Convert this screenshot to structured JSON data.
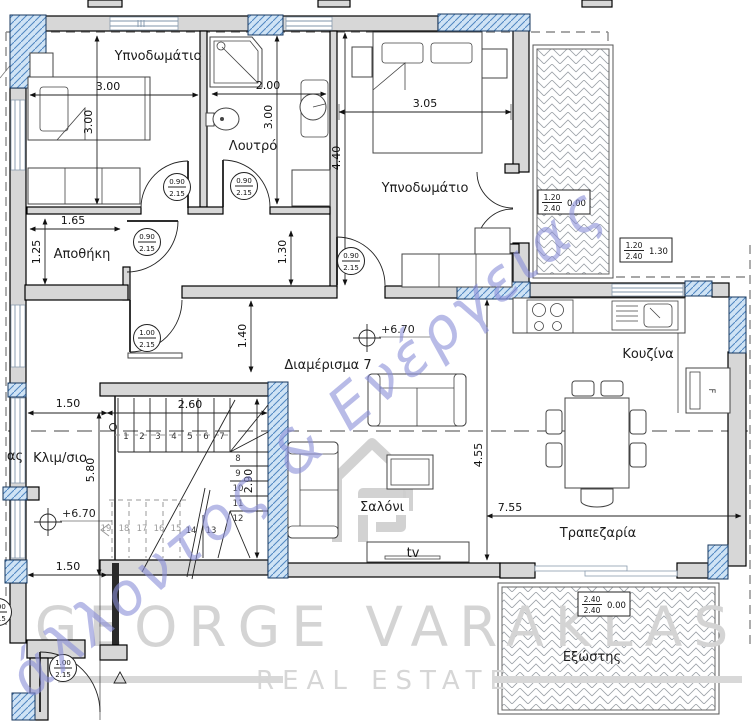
{
  "rooms": {
    "bedroom1": "Υπνοδωμάτιο",
    "bathroom": "Λουτρό",
    "bedroom2": "Υπνοδωμάτιο",
    "storage": "Αποθήκη",
    "apartment": "Διαμέρισμα 7",
    "kitchen": "Κουζίνα",
    "stairwell": "Κλιμ/σιο",
    "living": "Σαλόνι",
    "dining": "Τραπεζαρία",
    "balcony": "Εξώστης",
    "tv": "tv",
    "partial_left": "ας"
  },
  "levels": {
    "living": "+6.70",
    "stair": "+6.70"
  },
  "dims": {
    "bed1_w": "3.00",
    "bed1_h": "3.00",
    "bath_w": "2.00",
    "bath_h": "3.00",
    "bed2_w": "3.05",
    "bed2_h": "4.40",
    "storage_w": "1.65",
    "storage_h": "1.25",
    "hall_h": "1.30",
    "entry_h": "1.40",
    "stair_top": "1.50",
    "stair_w": "2.60",
    "stair_h": "2.90",
    "stair_total": "5.80",
    "stair_bottom": "1.50",
    "living_h": "4.55",
    "living_w": "7.55"
  },
  "door_tags": [
    {
      "w": "0.90",
      "h": "2.15"
    },
    {
      "w": "0.90",
      "h": "2.15"
    },
    {
      "w": "0.90",
      "h": "2.15"
    },
    {
      "w": "0.90",
      "h": "2.15"
    },
    {
      "w": "1.00",
      "h": "2.15"
    },
    {
      "w": "1.00",
      "h": "2.15"
    },
    {
      "w": "1.00",
      "h": "2.15"
    }
  ],
  "opening_boxes": [
    {
      "top": "1.20",
      "bottom": "2.40",
      "side": "0.00"
    },
    {
      "top": "1.20",
      "bottom": "2.40",
      "side": "1.30"
    },
    {
      "top": "2.40",
      "bottom": "2.40",
      "side": "0.00"
    }
  ],
  "stairs": {
    "numbers": [
      "1",
      "2",
      "3",
      "4",
      "5",
      "6",
      "7",
      "8",
      "9",
      "10",
      "11",
      "12",
      "13",
      "14",
      "15",
      "16",
      "17",
      "18",
      "19"
    ]
  },
  "fridge_label": "F",
  "watermark": {
    "brand": "GEORGE VARAKLAS",
    "tagline": "REAL ESTATE",
    "diagonal": "άλλοντος & Ενέργειας"
  },
  "colors": {
    "wall_gray": "#d7d7d7",
    "hatch_blue_fill": "#cfe3f5",
    "hatch_blue_line": "#4f86c0",
    "watermark_gray": "#d4d4d4",
    "watermark_blue": "#8a8ed8"
  }
}
